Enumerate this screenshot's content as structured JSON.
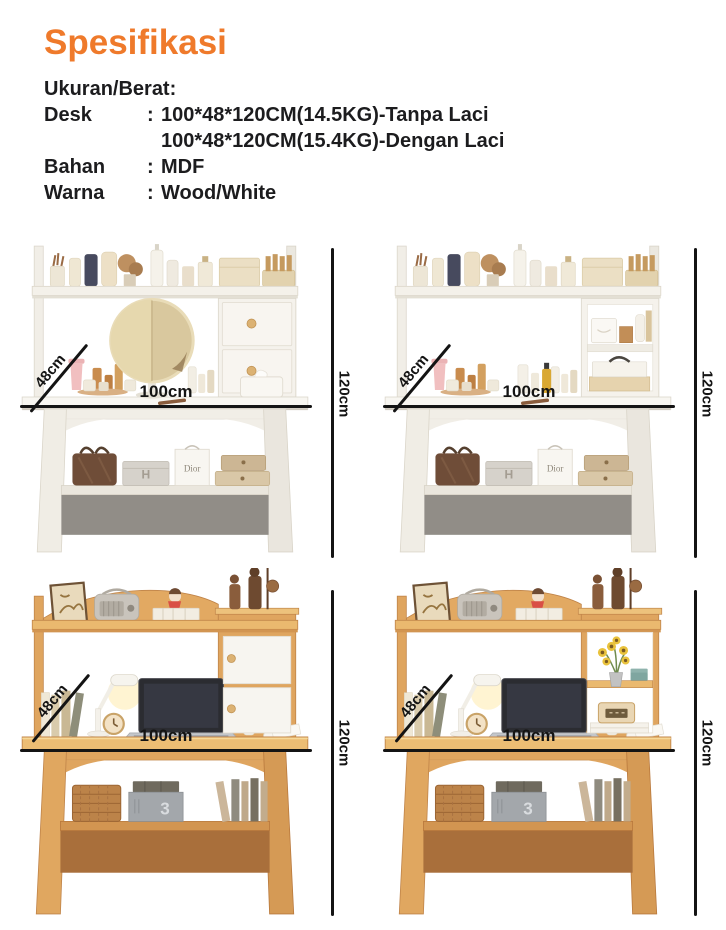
{
  "header": {
    "title": "Spesifikasi",
    "section_label": "Ukuran/Berat:",
    "rows": [
      {
        "label": "Desk",
        "colon": ":",
        "value": "100*48*120CM(14.5KG)-Tanpa Laci"
      },
      {
        "label": "",
        "colon": "",
        "value": "100*48*120CM(15.4KG)-Dengan Laci"
      },
      {
        "label": "Bahan",
        "colon": ":",
        "value": "MDF"
      },
      {
        "label": "Warna",
        "colon": ":",
        "value": "Wood/White"
      }
    ]
  },
  "dimensions": {
    "depth": "48cm",
    "width": "100cm",
    "height": "120cm"
  },
  "products": [
    {
      "id": "white-vanity-desk-with-drawers"
    },
    {
      "id": "white-vanity-desk-with-open-shelves"
    },
    {
      "id": "wood-desk-with-white-cabinet-doors"
    },
    {
      "id": "wood-desk-with-open-shelves"
    }
  ],
  "props": {
    "box_letter": "H",
    "bag_brand": "Dior",
    "box_number": "3"
  },
  "colors": {
    "accent": "#EF7A2B",
    "text": "#1C1C1E",
    "dimension_line": "#141414",
    "wood": "#DFA55F",
    "white_furniture": "#F2EFE9"
  }
}
